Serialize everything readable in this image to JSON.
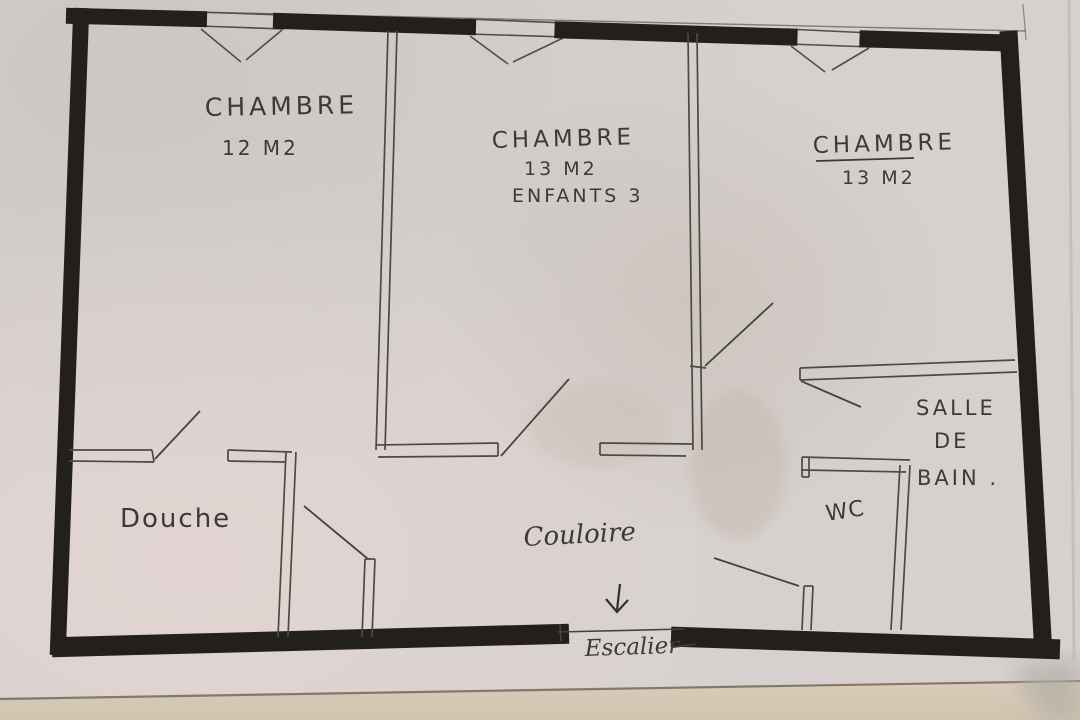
{
  "floorplan": {
    "rooms": [
      {
        "id": "bedroom-1",
        "name": "CHAMBRE",
        "area": "12 M2"
      },
      {
        "id": "bedroom-2",
        "name": "CHAMBRE",
        "area": "13 M2",
        "note": "ENFANTS 3"
      },
      {
        "id": "bedroom-3",
        "name": "CHAMBRE",
        "area": "13 M2"
      },
      {
        "id": "shower",
        "name": "Douche"
      },
      {
        "id": "hallway",
        "name": "Couloire"
      },
      {
        "id": "wc",
        "name": "WC"
      },
      {
        "id": "bathroom",
        "lines": [
          "SALLE",
          "DE",
          "BAIN ."
        ]
      },
      {
        "id": "staircase",
        "name": "Escalier"
      }
    ],
    "icons": {
      "hallway_arrow": "down-arrow"
    },
    "colors": {
      "ink_wall": "#221f1c",
      "pencil": "#57524b",
      "handwriting": "#3d3a36",
      "paper": "#d6d1cf"
    }
  }
}
